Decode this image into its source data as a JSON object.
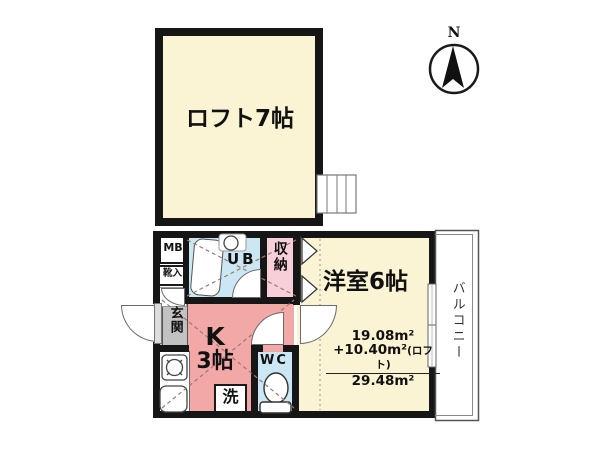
{
  "plan": {
    "compass": {
      "label": "N"
    },
    "loft": {
      "label": "ロフト7帖"
    },
    "western_room": {
      "label": "洋室6帖"
    },
    "kitchen": {
      "line1": "K",
      "line2": "3帖"
    },
    "unit_bath": {
      "label": "UB"
    },
    "storage": {
      "label": "収納"
    },
    "entrance": {
      "label": "玄関"
    },
    "meter_box": {
      "label": "MB"
    },
    "shoe_cabinet": {
      "label": "靴入"
    },
    "toilet": {
      "label": "WC"
    },
    "washer": {
      "label": "洗"
    },
    "balcony": {
      "label": "バルコニー"
    },
    "area": {
      "main": "19.08m²",
      "loft_add": "+10.40m²",
      "loft_note": "(ロフト)",
      "total": "29.48m²"
    },
    "colors": {
      "room_yellow": "#FAF4D4",
      "kitchen_pink": "#F3A8A8",
      "storage_pink": "#F7CFD9",
      "bath_blue": "#CBE7F3",
      "entrance_gray": "#C2C2C2",
      "wall_black": "#161616"
    }
  }
}
